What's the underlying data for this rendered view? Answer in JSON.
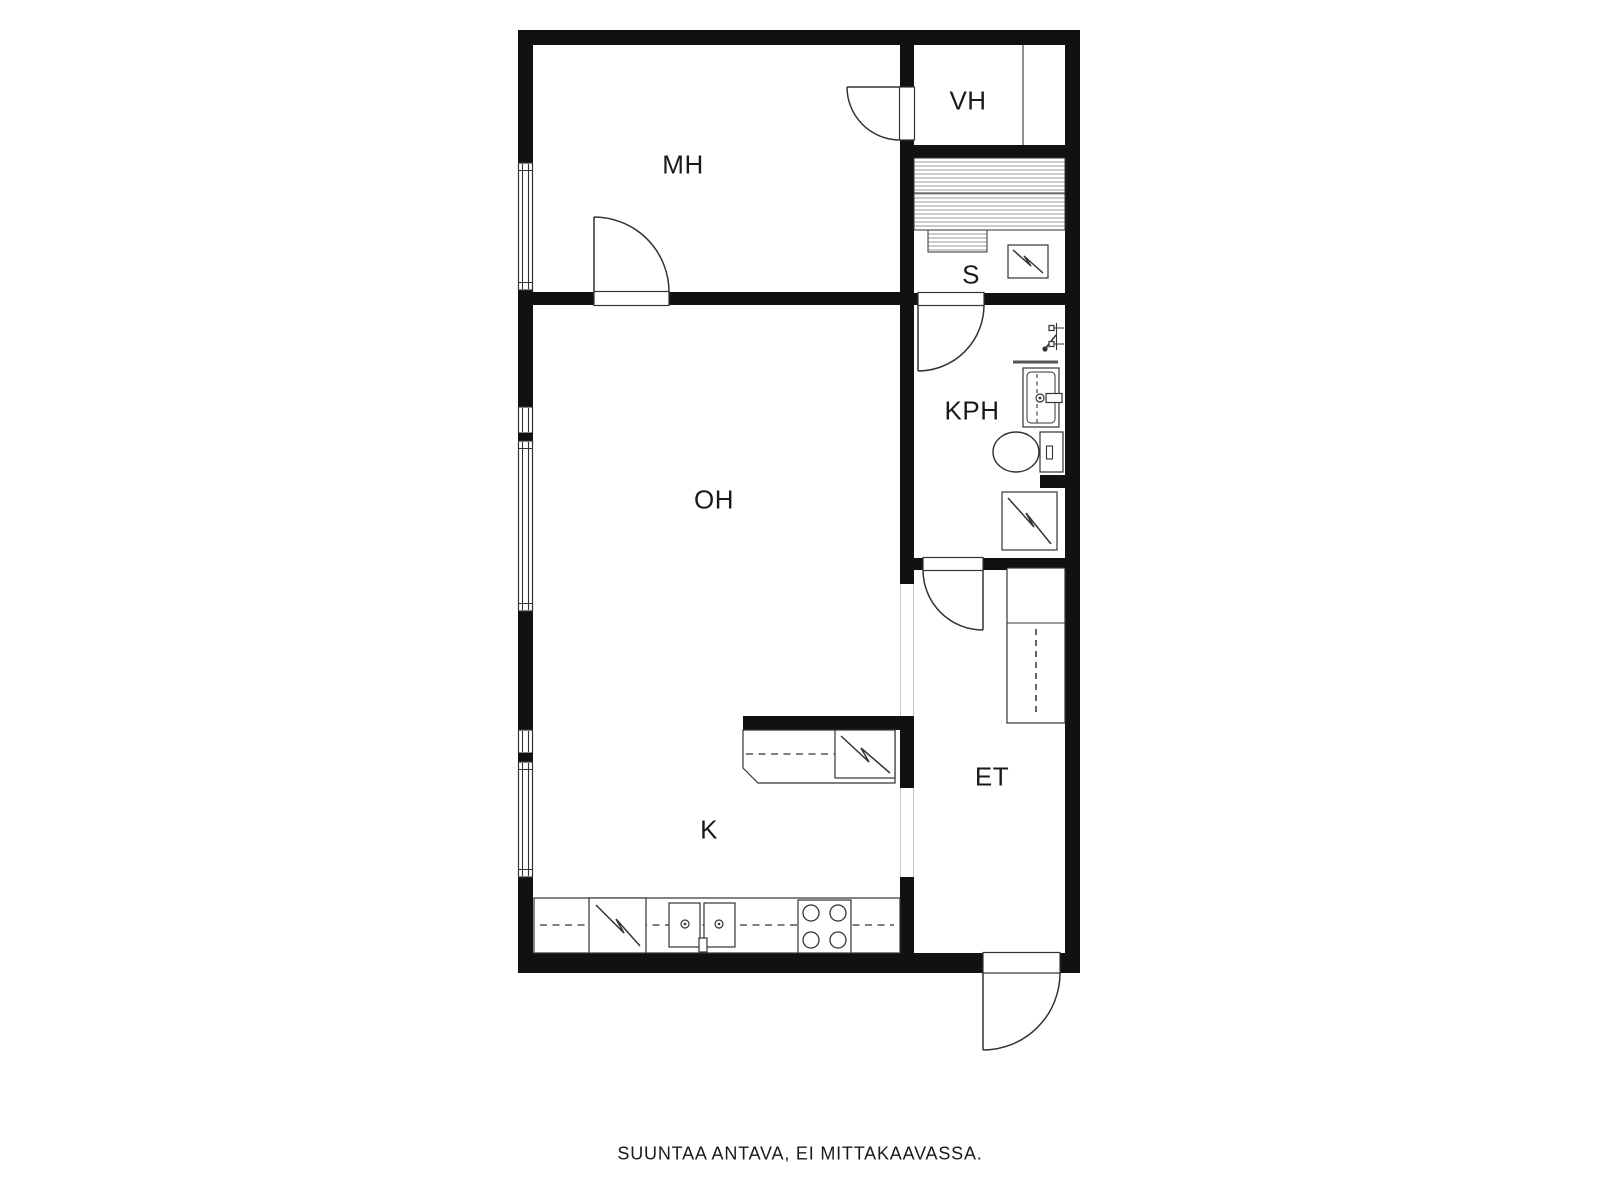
{
  "plan": {
    "rooms": [
      {
        "id": "mh",
        "label": "MH"
      },
      {
        "id": "vh",
        "label": "VH"
      },
      {
        "id": "s",
        "label": "S"
      },
      {
        "id": "kph",
        "label": "KPH"
      },
      {
        "id": "oh",
        "label": "OH"
      },
      {
        "id": "k",
        "label": "K"
      },
      {
        "id": "et",
        "label": "ET"
      }
    ],
    "fixtures": [
      "window",
      "door-swing",
      "sauna-bench",
      "sauna-stove",
      "shower-mixer",
      "washbasin",
      "toilet",
      "washing-machine",
      "coat-closet",
      "wardrobe-partition",
      "kitchen-counter",
      "kitchen-island-counter",
      "refrigerator",
      "kitchen-sink",
      "cooktop"
    ],
    "colors": {
      "wall": "#111111",
      "line": "#333333",
      "dash": "#555555",
      "background": "#ffffff"
    }
  },
  "footer": {
    "note": "SUUNTAA ANTAVA, EI MITTAKAAVASSA."
  }
}
